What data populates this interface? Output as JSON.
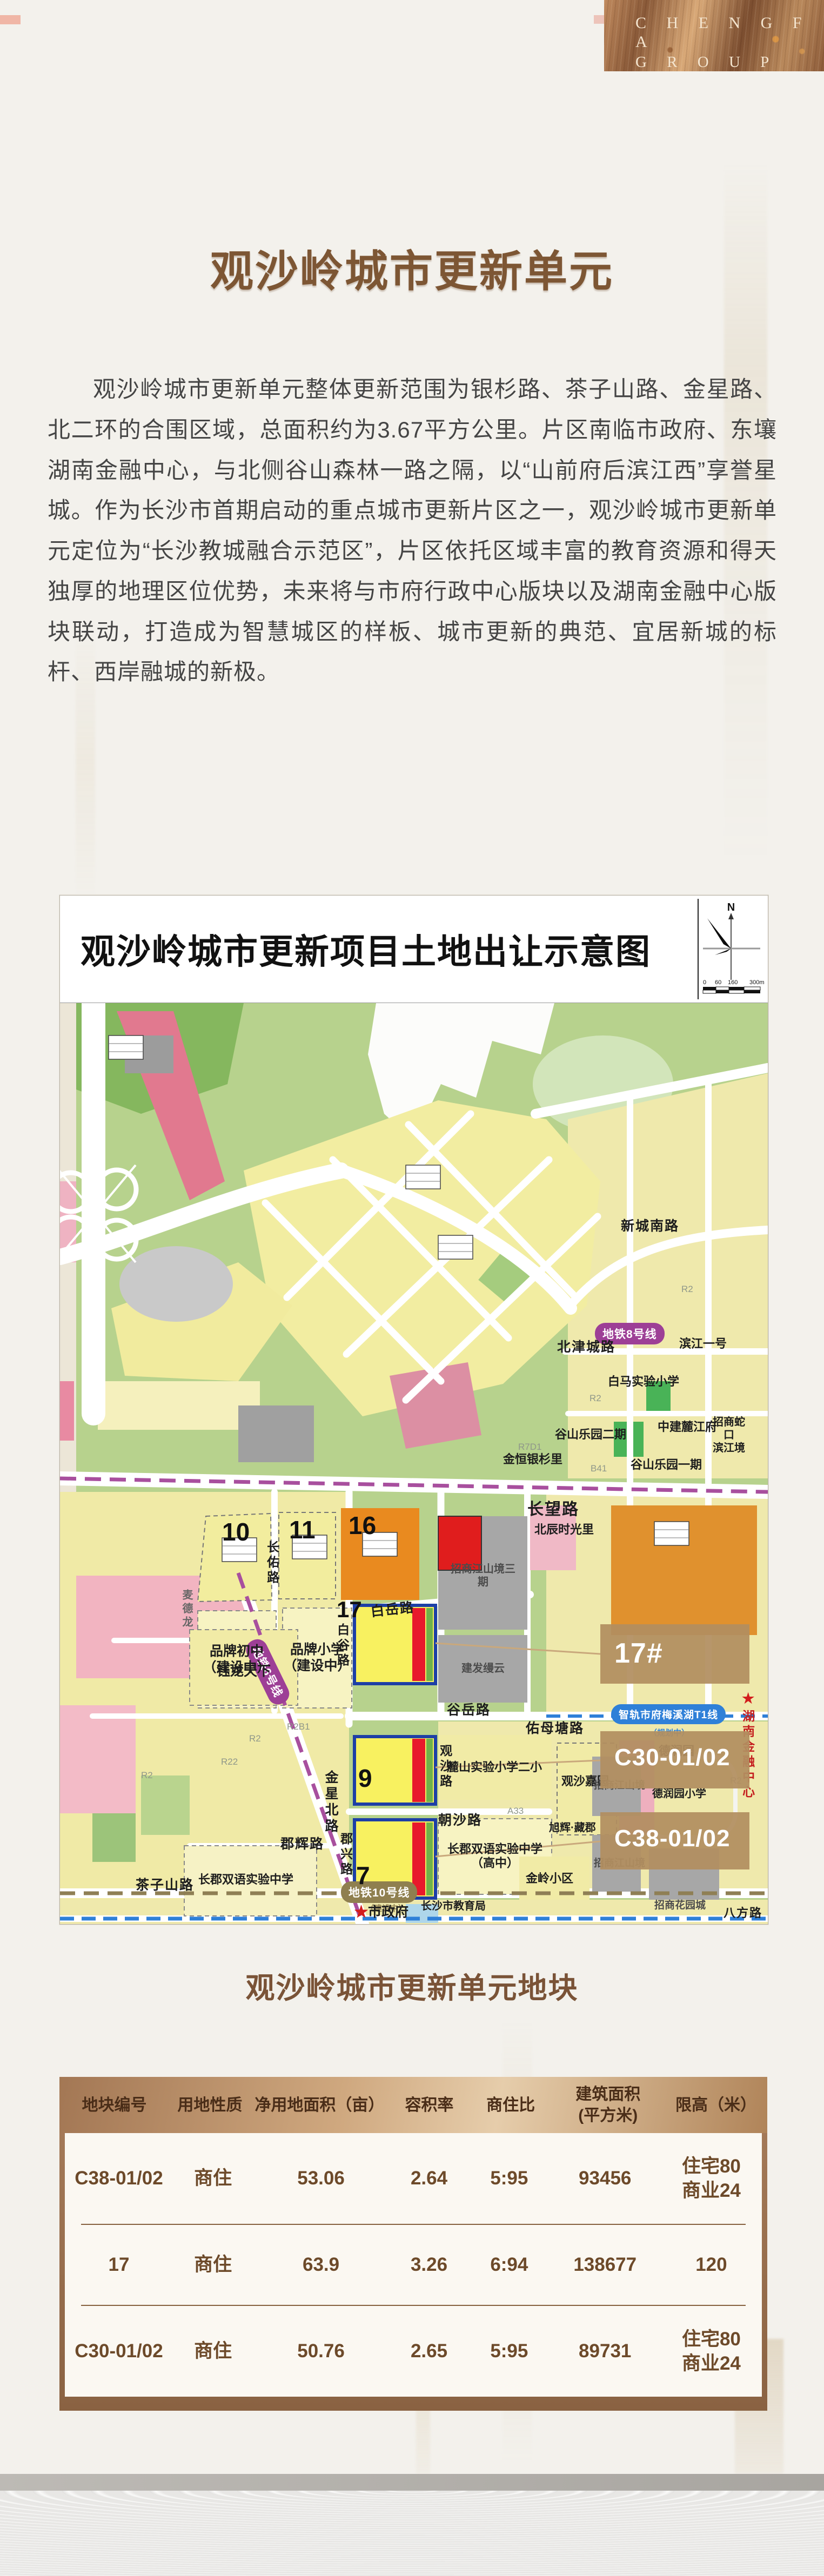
{
  "brand": {
    "line1": "C H E N G  F A",
    "line2": "G R O U P"
  },
  "page": {
    "title": "观沙岭城市更新单元",
    "intro": "观沙岭城市更新单元整体更新范围为银杉路、茶子山路、金星路、北二环的合围区域，总面积约为3.67平方公里。片区南临市政府、东壤湖南金融中心，与北侧谷山森林一路之隔，以“山前府后滨江西”享誉星城。作为长沙市首期启动的重点城市更新片区之一，观沙岭城市更新单元定位为“长沙教城融合示范区”，片区依托区域丰富的教育资源和得天独厚的地理区位优势，未来将与市府行政中心版块以及湖南金融中心版块联动，打造成为智慧城区的样板、城市更新的典范、宜居新城的标杆、西岸融城的新极。"
  },
  "map": {
    "title": "观沙岭城市更新项目土地出让示意图",
    "compass": "N",
    "scale": {
      "t0": "0",
      "t1": "60",
      "t2": "160",
      "t3": "300m"
    },
    "roads": {
      "changwang": "长望路",
      "baiyue": "白岳路",
      "baigu": "白谷路",
      "changyou": "长佑路",
      "guyue": "谷岳路",
      "chaosha": "朝沙路",
      "junxing": "郡兴路",
      "guansha": "观沙路",
      "junhui": "郡辉路",
      "xinchengnan": "新城南路",
      "beijincheng": "北津城路",
      "youmutang": "佑母塘路",
      "chazishan": "茶子山路",
      "jinxingbei": "金星北路",
      "bafang": "八方路"
    },
    "transit": {
      "line8": "地铁8号线",
      "line6": "地铁6号线",
      "tram": "智轨市府梅溪湖T1线",
      "tram_note": "（规划中）",
      "line10": "地铁10号线",
      "line10_note": "（建设中）"
    },
    "parcels": {
      "p10": "10",
      "p11": "11",
      "p16": "16",
      "p17": "17",
      "p9": "9",
      "p7": "7"
    },
    "callouts": {
      "c17": "17#",
      "c30": "C30-01/02",
      "c38": "C38-01/02"
    },
    "places": {
      "gushan2": "谷山乐园二期",
      "gushan1": "谷山乐园一期",
      "jinheng": "金恒银杉里",
      "beichen": "北辰时光里",
      "binjiang": "滨江一号",
      "baima": "白马实验小学",
      "zhongjian": "中建麓江府",
      "zsk": "招商蛇口\n滨江境",
      "zsjs3": "招商江山境三期",
      "jianfa": "建发缦云",
      "pinpaichuzhong": "品牌初中\n（建设中）",
      "pinpaixiaoxue": "品牌小学\n（建设中）",
      "yulong": "钰龙天下",
      "maidelong": "麦德龙",
      "lushan": "麓山实验小学二小",
      "changjungz": "长郡双语实验中学\n（高中）",
      "guanshajy": "观沙嘉园",
      "derunyuan": "德润园",
      "derunxx": "德润园小学",
      "jinling": "金岭小区",
      "zsjs": "招商江山境",
      "zshy": "招商花园城",
      "xuhui": "旭辉·藏郡",
      "changjun": "长郡双语实验中学",
      "jiaoyuju": "长沙市教育局",
      "shizhengfu": "市政府",
      "hnjr": "湖南金融中心"
    },
    "codes": {
      "r2": "R2",
      "r22": "R22",
      "r2b1": "R2B1",
      "a33": "A33",
      "r7d1": "R7D1",
      "b41": "B41"
    }
  },
  "section": {
    "title": "观沙岭城市更新单元地块"
  },
  "table": {
    "headers": [
      "地块编号",
      "用地性质",
      "净用地面积（亩）",
      "容积率",
      "商住比",
      "建筑面积\n(平方米)",
      "限高（米）"
    ],
    "rows": [
      {
        "id": "C38-01/02",
        "use": "商住",
        "area": "53.06",
        "far": "2.64",
        "ratio": "5:95",
        "gfa": "93456",
        "limit": "住宅80\n商业24"
      },
      {
        "id": "17",
        "use": "商住",
        "area": "63.9",
        "far": "3.26",
        "ratio": "6:94",
        "gfa": "138677",
        "limit": "120"
      },
      {
        "id": "C30-01/02",
        "use": "商住",
        "area": "50.76",
        "far": "2.65",
        "ratio": "5:95",
        "gfa": "89731",
        "limit": "住宅80\n商业24"
      }
    ]
  }
}
